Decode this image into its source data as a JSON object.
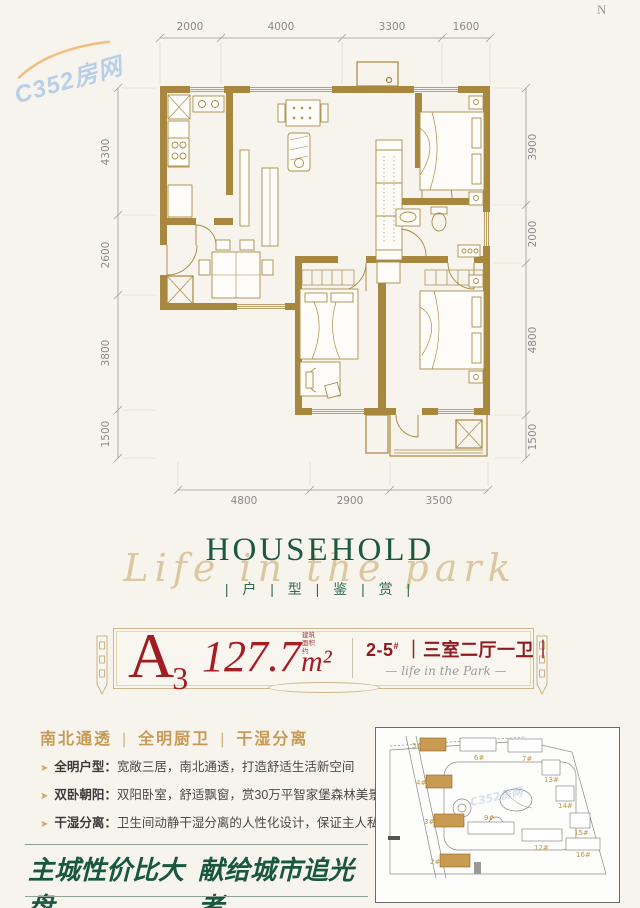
{
  "watermark": {
    "text": "C352房网"
  },
  "compass": {
    "label": "N"
  },
  "floorplan": {
    "dims_top": [
      "2000",
      "4000",
      "3300",
      "1600"
    ],
    "dims_left": [
      "4300",
      "2600",
      "3800",
      "1500"
    ],
    "dims_right": [
      "3900",
      "2000",
      "4800",
      "1500"
    ],
    "dims_bottom": [
      "4800",
      "2900",
      "3500"
    ]
  },
  "section_title": {
    "main": "HOUSEHOLD",
    "script": "Life in the park",
    "sub": "| 户 | 型 | 鉴 | 赏 |"
  },
  "unit_card": {
    "unit_letter": "A",
    "unit_number": "3",
    "area_value": "127.7",
    "area_unit": "m²",
    "area_note": "建筑面积约",
    "buildings": "2-5",
    "buildings_mark": "#",
    "layout": "｜三室二厅一卫｜",
    "dash": "—",
    "tagline": "life in the Park"
  },
  "features": {
    "separator": "|",
    "items": [
      "南北通透",
      "全明厨卫",
      "干湿分离"
    ]
  },
  "bullet_icon": "➤",
  "selling_points": [
    {
      "label": "全明户型：",
      "text": "宽敞三居，南北通透，打造舒适生活新空间"
    },
    {
      "label": "双卧朝阳：",
      "text": "双阳卧室，舒适飘窗，赏30万平智家堡森林美景"
    },
    {
      "label": "干湿分离：",
      "text": "卫生间动静干湿分离的人性化设计，保证主人私密生活"
    }
  ],
  "slogan": {
    "left": "主城性价比大盘",
    "right": "献给城市追光者"
  },
  "sitemap": {
    "buildings": [
      "5#",
      "6#",
      "7#",
      "13#",
      "4#",
      "14#",
      "3#",
      "9#",
      "15#",
      "12#",
      "16#",
      "2#"
    ]
  },
  "colors": {
    "accent_red": "#9e1c22",
    "gold": "#c79a55",
    "green": "#1d5a3c",
    "wall_brown": "#a8873f"
  }
}
